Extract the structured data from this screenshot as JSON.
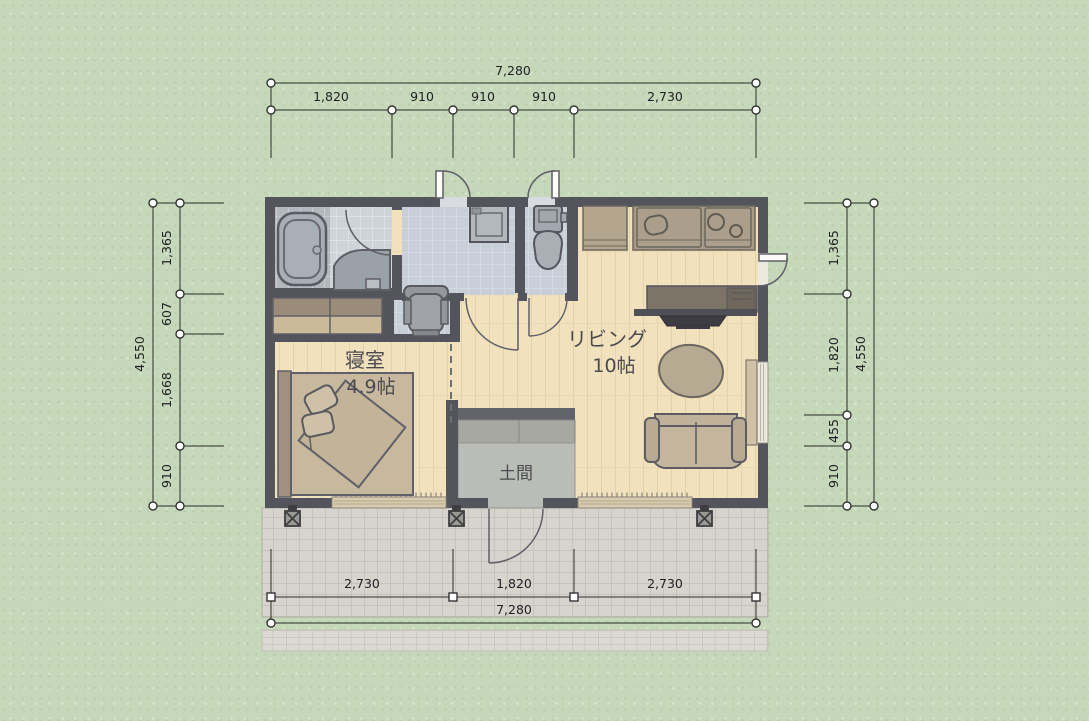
{
  "canvas": {
    "width": 1089,
    "height": 721
  },
  "background": {
    "color": "#c6d8ba"
  },
  "floor_plan": {
    "rooms": {
      "bedroom": {
        "name": "寝室",
        "size": "4.9帖"
      },
      "living": {
        "name": "リビング",
        "size": "10帖"
      },
      "doma": {
        "name": "土間"
      }
    },
    "colors": {
      "wall": "#54545c",
      "wood_floor": "#f1e1bd",
      "wet_area_floor": "#c9cfd8",
      "bath_tile": "#b2b8be",
      "doma_floor": "#babdb7",
      "deck_tile": "#d7d4ce",
      "kitchen_counter": "#a89a85",
      "furniture_beige": "#c4b69e",
      "dimension_line": "#2b2b2b"
    },
    "furniture_icons": [
      "bathtub-icon",
      "washbasin-icon",
      "washing-machine-icon",
      "toilet-icon",
      "office-chair-icon",
      "closet-icon",
      "bed-icon",
      "refrigerator-icon",
      "kitchen-sink-icon",
      "stove-icon",
      "tv-board-icon",
      "tv-icon",
      "round-table-icon",
      "sofa-icon",
      "deck-post-icon"
    ]
  },
  "dimensions": {
    "top": {
      "total": "7,280",
      "segments": [
        "1,820",
        "910",
        "910",
        "910",
        "2,730"
      ]
    },
    "bottom": {
      "total": "7,280",
      "segments": [
        "2,730",
        "1,820",
        "2,730"
      ]
    },
    "left": {
      "total": "4,550",
      "segments": [
        "1,365",
        "607",
        "1,668",
        "910"
      ]
    },
    "right": {
      "total": "4,550",
      "segments": [
        "1,365",
        "1,820",
        "455",
        "910"
      ]
    }
  }
}
